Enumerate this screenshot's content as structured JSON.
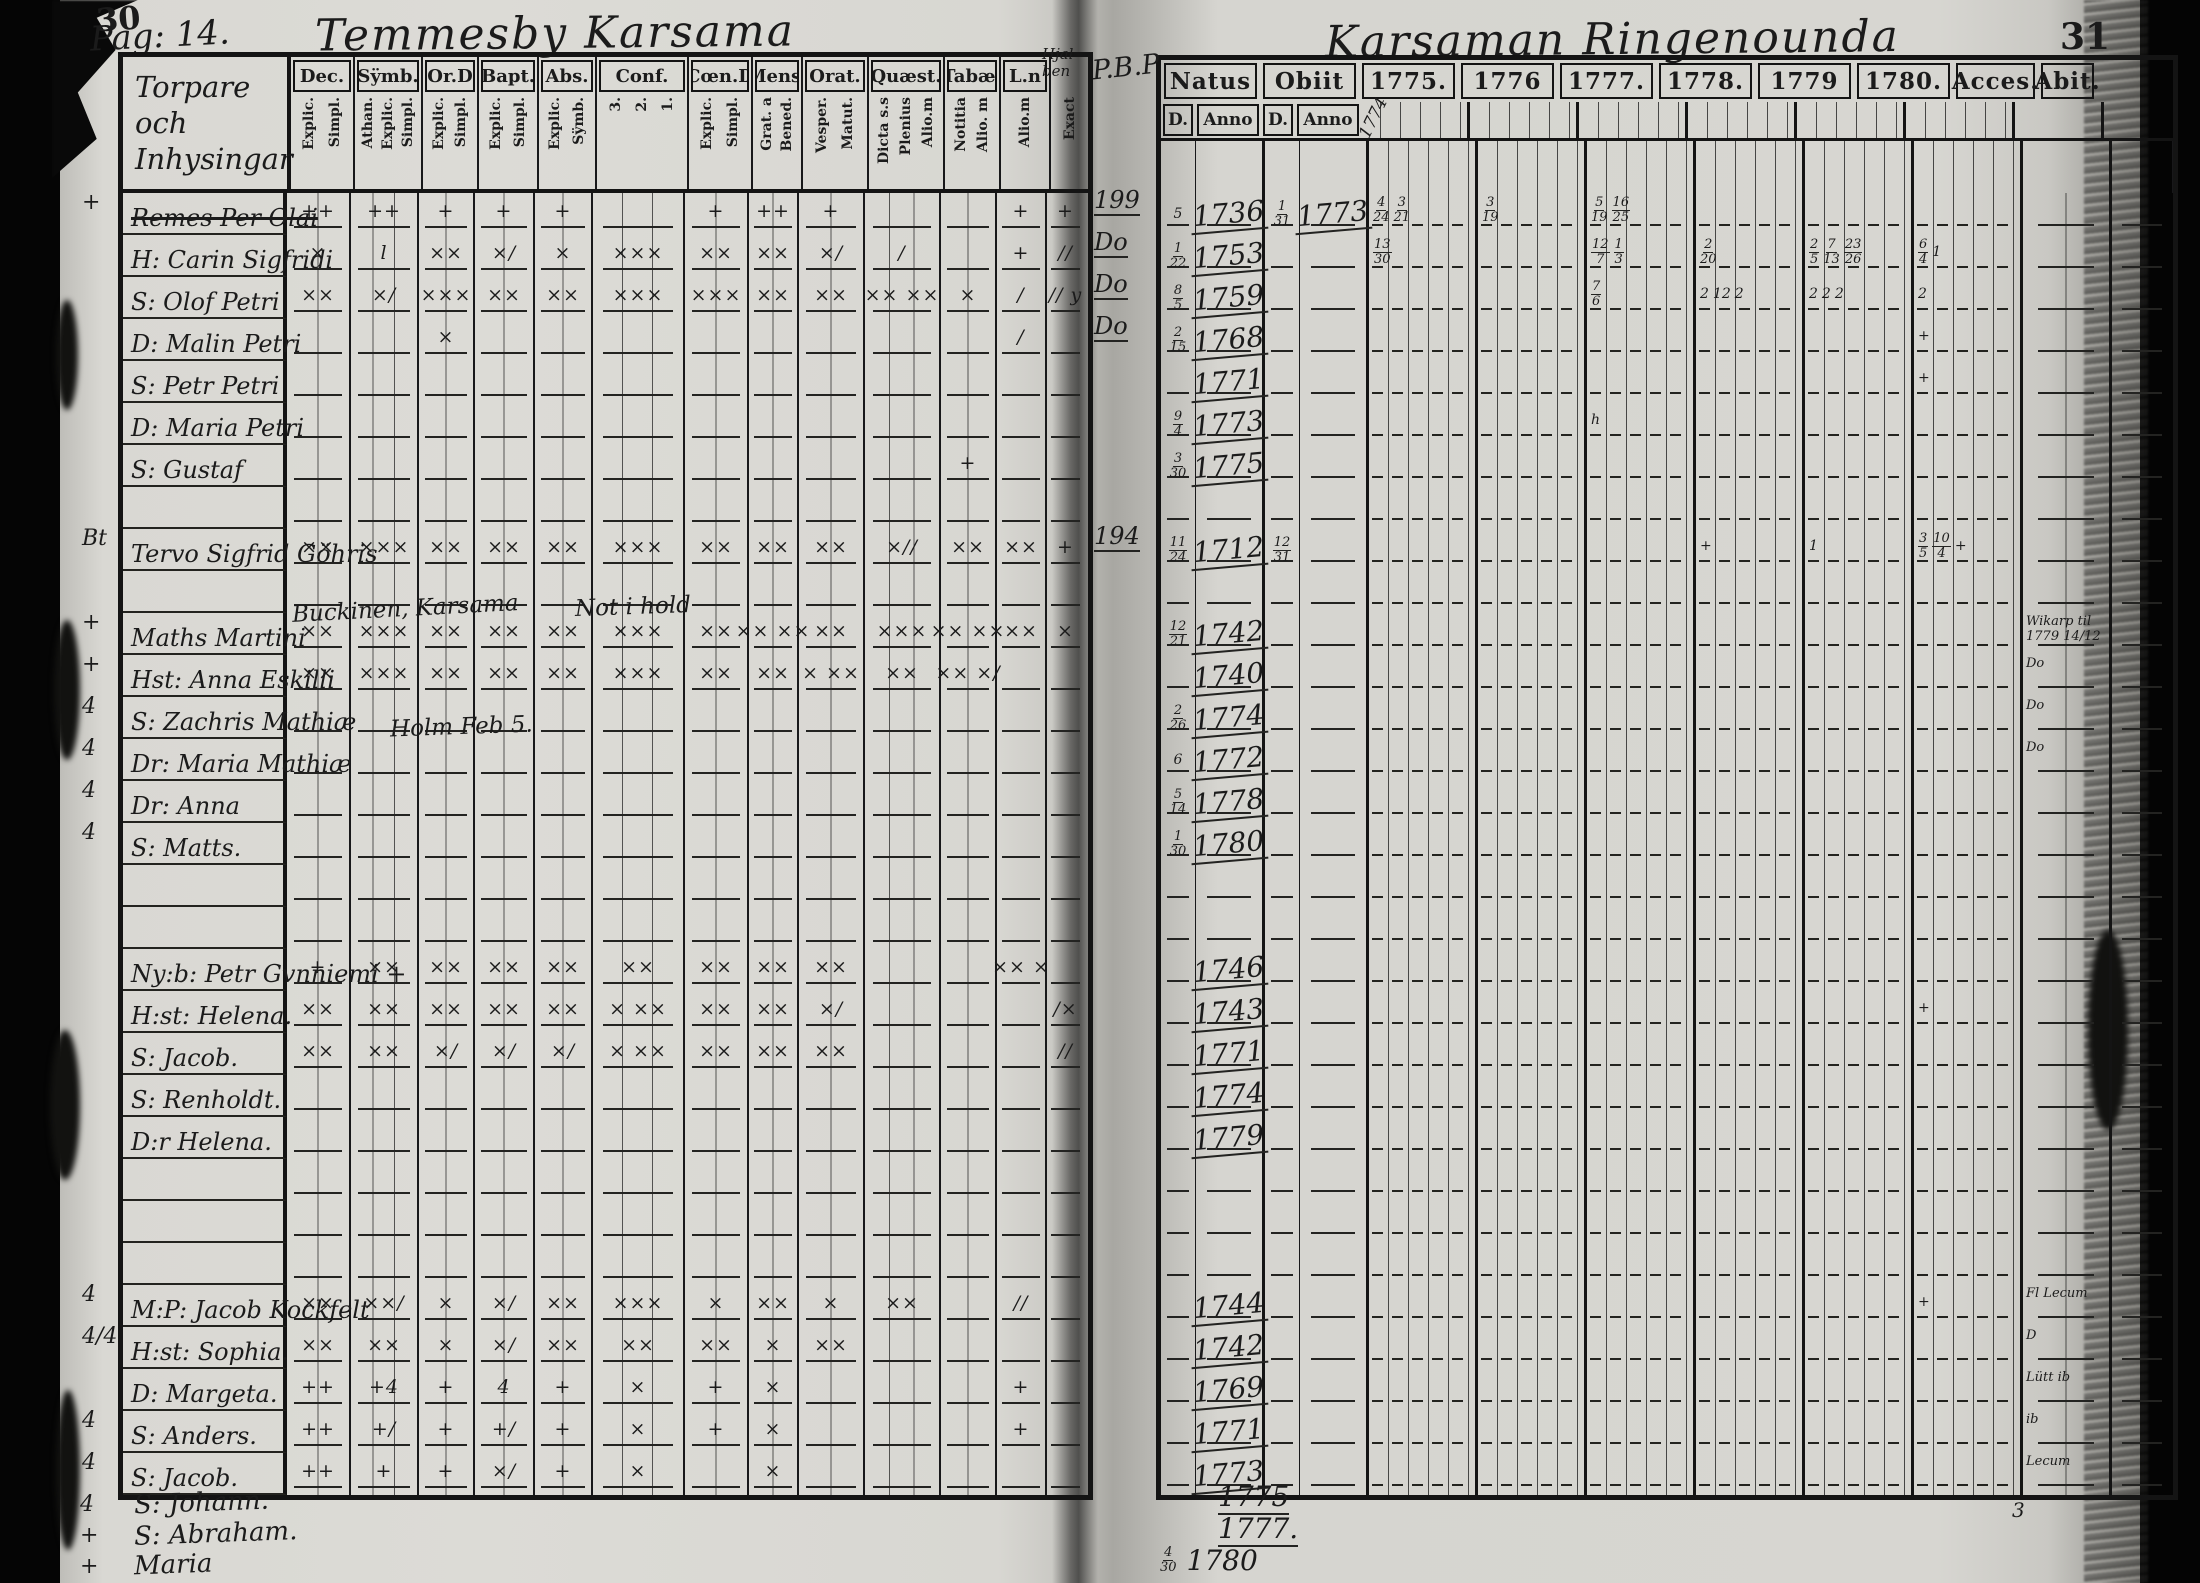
{
  "meta": {
    "left_page_no": "30",
    "right_page_no": "31"
  },
  "left": {
    "pag": "Pag: 14.",
    "title": "Temmesby Karsama",
    "hjal_note": [
      "Hjal",
      "ben"
    ],
    "names_header": [
      "Torpare och",
      "Inhysingar"
    ],
    "columns": [
      {
        "label": "Dec.",
        "subs": [
          "Explic.",
          "Simpl."
        ],
        "lines": 2
      },
      {
        "label": "Sÿmb.",
        "subs": [
          "Athan.",
          "Explic.",
          "Simpl."
        ],
        "lines": 3
      },
      {
        "label": "Or.D",
        "subs": [
          "Explic.",
          "Simpl."
        ],
        "lines": 2
      },
      {
        "label": "Bapt.",
        "subs": [
          "Explic.",
          "Simpl."
        ],
        "lines": 2
      },
      {
        "label": "Abs.",
        "subs": [
          "Explic.",
          "Sÿmb."
        ],
        "lines": 2
      },
      {
        "label": "Conf.",
        "subs": [
          "3.",
          "2.",
          "1."
        ],
        "lines": 3
      },
      {
        "label": "Cœn.D",
        "subs": [
          "Explic.",
          "Simpl."
        ],
        "lines": 2
      },
      {
        "label": "Mens.",
        "subs": [
          "Grat. a",
          "Bened."
        ],
        "lines": 2
      },
      {
        "label": "Orat.",
        "subs": [
          "Vesper.",
          "Matut."
        ],
        "lines": 2
      },
      {
        "label": "Quæst.",
        "subs": [
          "Dicta s.s",
          "Plenius",
          "Alio.m"
        ],
        "lines": 3
      },
      {
        "label": "Tabæ.",
        "subs": [
          "Notitia",
          "Alio. m"
        ],
        "lines": 2
      },
      {
        "label": "L.n",
        "subs": [
          "Alio.m"
        ],
        "lines": 1
      },
      {
        "label": "",
        "subs": [
          "Exact"
        ],
        "lines": 1
      }
    ],
    "rows": [
      {
        "m": "+",
        "n": "Remes Per Olai",
        "s": true,
        "k": [
          "++",
          "++",
          "+",
          "+",
          "+",
          "",
          "+",
          "++",
          "+",
          "",
          "",
          "+",
          "+"
        ]
      },
      {
        "n": "H: Carin Sigfridi",
        "k": [
          "×",
          "l",
          "××",
          "×/",
          "×",
          "×××",
          "××",
          "××",
          "×/",
          "/",
          "",
          "+",
          "//"
        ]
      },
      {
        "n": "S: Olof Petri",
        "k": [
          "××",
          "×/",
          "×××",
          "××",
          "××",
          "×××",
          "×××",
          "××",
          "××",
          "×× ××",
          "×",
          "/",
          "// y"
        ]
      },
      {
        "n": "D: Malin Petri",
        "k": [
          "",
          "",
          "×",
          "",
          "",
          "",
          "",
          "",
          "",
          "",
          "",
          "/",
          ""
        ]
      },
      {
        "n": "S: Petr Petri",
        "k": []
      },
      {
        "n": "D: Maria Petri",
        "k": []
      },
      {
        "n": "S: Gustaf",
        "k": [
          "",
          "",
          "",
          "",
          "",
          "",
          "",
          "",
          "",
          "",
          "+",
          "",
          ""
        ]
      },
      {
        "b": true
      },
      {
        "m": "Bt",
        "n": "Tervo Sigfrid Göhris",
        "k": [
          "××",
          "×××",
          "××",
          "××",
          "××",
          "×××",
          "××",
          "××",
          "××",
          "×//",
          "××",
          "××",
          "+"
        ]
      },
      {
        "b": true
      },
      {
        "m": "+",
        "n": "Maths Martini",
        "k": [
          "××",
          "×××",
          "××",
          "××",
          "××",
          "×××",
          "××",
          "×× ××",
          "××",
          "×××",
          "×× ××",
          "××",
          "×"
        ]
      },
      {
        "m": "+",
        "n": "Hst: Anna Eskilli",
        "k": [
          "××",
          "×××",
          "××",
          "××",
          "××",
          "×××",
          "××",
          "××",
          "× ××",
          "××",
          "×× ×/",
          "",
          ""
        ]
      },
      {
        "m": "4",
        "n": "S: Zachris Mathiæ",
        "k": []
      },
      {
        "m": "4",
        "n": "Dr: Maria Mathiæ",
        "k": []
      },
      {
        "m": "4",
        "n": "Dr: Anna",
        "k": []
      },
      {
        "m": "4",
        "n": "S: Matts.",
        "k": []
      },
      {
        "b": true
      },
      {
        "b": true
      },
      {
        "n": "Ny:b: Petr Gvnniemi +",
        "k": [
          "+",
          "××",
          "××",
          "××",
          "××",
          "××",
          "××",
          "××",
          "××",
          "",
          "",
          "×× ×",
          ""
        ]
      },
      {
        "n": "H:st: Helena.",
        "k": [
          "××",
          "××",
          "××",
          "××",
          "××",
          "× ××",
          "××",
          "××",
          "×/",
          "",
          "",
          "",
          "/×"
        ]
      },
      {
        "n": "S: Jacob.",
        "k": [
          "××",
          "××",
          "×/",
          "×/",
          "×/",
          "× ××",
          "××",
          "××",
          "××",
          "",
          "",
          "",
          "//"
        ]
      },
      {
        "n": "S: Renholdt.",
        "k": []
      },
      {
        "n": "D:r Helena.",
        "k": []
      },
      {
        "b": true
      },
      {
        "b": true
      },
      {
        "b": true
      },
      {
        "m": "4",
        "n": "M:P: Jacob Kockfelt",
        "k": [
          "××",
          "××/",
          "×",
          "×/",
          "××",
          "×××",
          "×",
          "××",
          "×",
          "××",
          "",
          "//",
          ""
        ]
      },
      {
        "m": "4/4",
        "n": "H:st: Sophia.",
        "k": [
          "××",
          "××",
          "×",
          "×/",
          "××",
          "××",
          "××",
          "×",
          "××",
          "",
          "",
          "",
          ""
        ]
      },
      {
        "n": "D: Margeta.",
        "k": [
          "++",
          "+4",
          "+",
          "4",
          "+",
          "×",
          "+",
          "×",
          "",
          "",
          "",
          "+",
          ""
        ]
      },
      {
        "m": "4",
        "n": "S: Anders.",
        "k": [
          "++",
          "+/",
          "+",
          "+/",
          "+",
          "×",
          "+",
          "×",
          "",
          "",
          "",
          "+",
          ""
        ]
      },
      {
        "m": "4",
        "n": "S: Jacob.",
        "k": [
          "++",
          "+",
          "+",
          "×/",
          "+",
          "×",
          "",
          "×",
          "",
          "",
          "",
          "",
          ""
        ]
      }
    ],
    "below_rows": [
      {
        "margin": "4",
        "name": "S: Johann."
      },
      {
        "margin": "+",
        "name": "S: Abraham."
      },
      {
        "margin": "+",
        "name": "Maria"
      }
    ],
    "notes": [
      {
        "text": "Buckinen, Karsama",
        "x": 292,
        "y": 596,
        "size": 23,
        "rot": -3
      },
      {
        "text": "Not i hold",
        "x": 575,
        "y": 594,
        "size": 23,
        "rot": -2
      },
      {
        "text": "Holm Feb 5.",
        "x": 390,
        "y": 714,
        "size": 23,
        "rot": -2
      }
    ]
  },
  "right": {
    "corner": "P.B.P",
    "title": "Karsaman Ringenounda",
    "diag_note": "1774",
    "natus": "Natus",
    "obiit": "Obiit",
    "d": "D.",
    "anno": "Anno",
    "years": [
      "1775.",
      "1776",
      "1777.",
      "1778.",
      "1779",
      "1780."
    ],
    "acces": "Acces.",
    "abit": "Abit.",
    "rows": [
      {
        "m": "199",
        "nd": "5",
        "na": "1736",
        "od": "1/31",
        "oa": "1773",
        "ann": {
          "0": "4/24 3/21",
          "1": "3/19",
          "2": "5/19 16/25"
        }
      },
      {
        "m": "Do",
        "nd": "1/22",
        "na": "1753",
        "ann": {
          "0": "13/30",
          "2": "12/7 1/3",
          "3": "2/20",
          "4": "2/5 7/13 23/26",
          "5": "6/4 1"
        }
      },
      {
        "m": "Do",
        "nd": "8/5",
        "na": "1759",
        "ann": {
          "2": "7/6",
          "3": "2 12 2",
          "4": "2 2 2",
          "5": "2"
        }
      },
      {
        "m": "Do",
        "nd": "2/15",
        "na": "1768",
        "ann": {
          "5": "+"
        }
      },
      {
        "na": "1771",
        "ann": {
          "5": "+"
        }
      },
      {
        "nd": "9/4",
        "na": "1773",
        "ann": {
          "2": "h"
        }
      },
      {
        "nd": "3/30",
        "na": "1775"
      },
      {},
      {
        "m": "194",
        "nd": "11/24",
        "na": "1712",
        "od": "12/31",
        "ann": {
          "3": "+",
          "4": "1",
          "5": "3/5 10/4 +"
        }
      },
      {},
      {
        "nd": "12/21",
        "na": "1742",
        "acc": "Wikarp til|1779 14/12"
      },
      {
        "na": "1740",
        "acc": "Do"
      },
      {
        "nd": "2/26",
        "na": "1774",
        "acc": "Do"
      },
      {
        "nd": "6",
        "na": "1772",
        "acc": "Do"
      },
      {
        "nd": "5/14",
        "na": "1778"
      },
      {
        "nd": "1/30",
        "na": "1780"
      },
      {},
      {},
      {
        "na": "1746"
      },
      {
        "na": "1743",
        "ann": {
          "5": "+"
        }
      },
      {
        "na": "1771"
      },
      {
        "na": "1774"
      },
      {
        "na": "1779"
      },
      {},
      {},
      {},
      {
        "na": "1744",
        "ann": {
          "5": "+"
        },
        "acc": "Fl Lecum"
      },
      {
        "na": "1742",
        "acc": "D"
      },
      {
        "na": "1769",
        "acc": "Lütt ib"
      },
      {
        "na": "1771",
        "acc": "ib"
      },
      {
        "na": "1773",
        "acc": "Lecum"
      }
    ],
    "below_rows": [
      {
        "na": "1775"
      },
      {
        "na": "1777."
      },
      {
        "nd": "4/30",
        "na": "1780"
      }
    ],
    "abit_below": "3"
  }
}
